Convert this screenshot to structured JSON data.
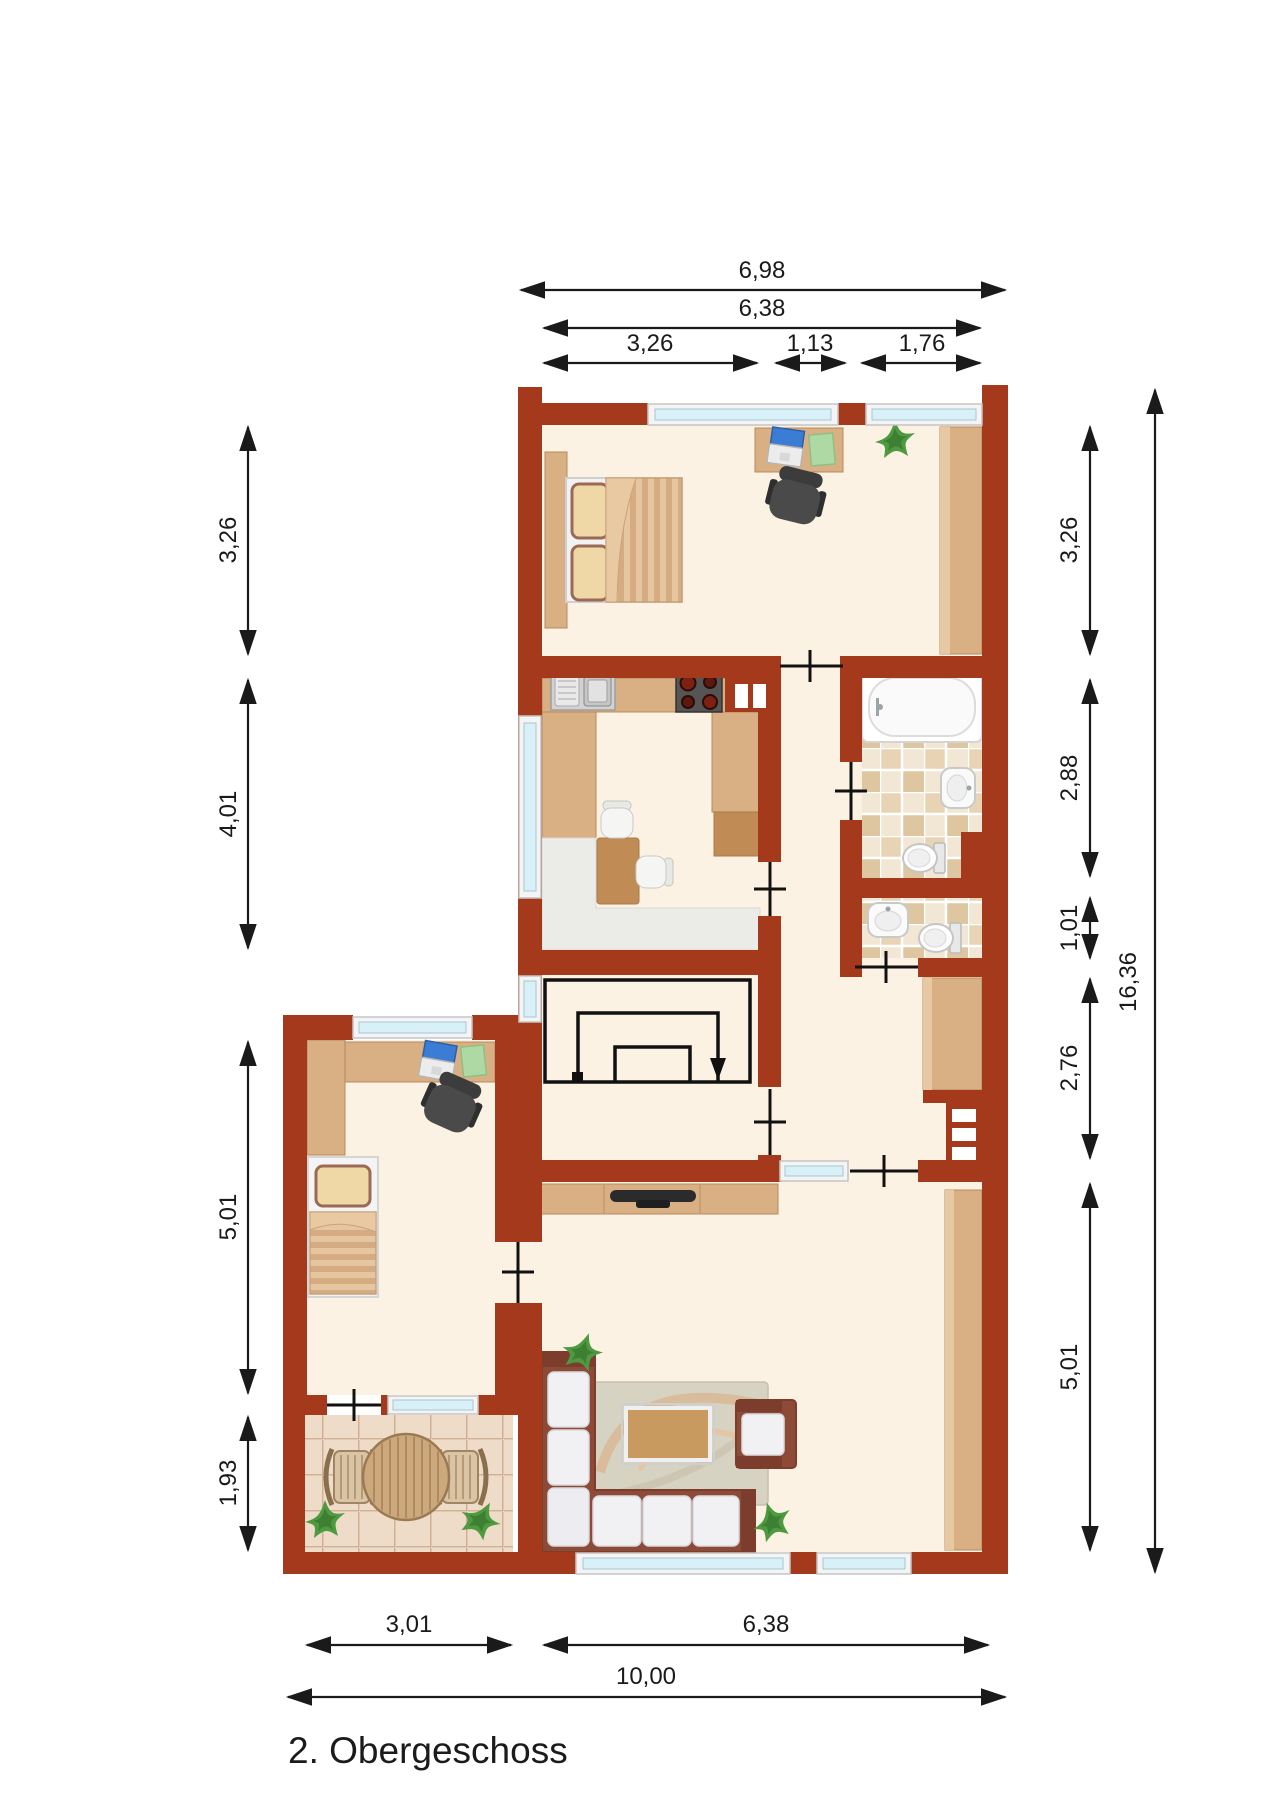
{
  "title": "2. Obergeschoss",
  "dimensions": {
    "top": [
      "6,98",
      "6,38",
      "3,26",
      "1,13",
      "1,76"
    ],
    "left": [
      "3,26",
      "4,01",
      "5,01",
      "1,93"
    ],
    "right": [
      "3,26",
      "2,88",
      "1,01",
      "2,76",
      "5,01"
    ],
    "right_total": "16,36",
    "bottom": [
      "3,01",
      "6,38",
      "10,00"
    ]
  },
  "colors": {
    "wall": "#A4391B",
    "floor": "#FBF2E3",
    "wood": "#D9B083",
    "wood_dark": "#C08B55",
    "glass": "#D8F0F8",
    "frame": "#F4F4F4",
    "line": "#1A1A1A",
    "grey_counter": "#EBEBE7",
    "sofa": "#8D4A37",
    "sofa_dark": "#7C3D2C",
    "cushion": "#F1F1F4",
    "plant": "#4D9A40",
    "tile_a": "#F1E3CC",
    "tile_b": "#E2CBA6",
    "balcony_tile": "#EFDCC8"
  },
  "legend": {
    "rooms": [
      "bedroom-main",
      "kitchen",
      "bathroom",
      "wc",
      "stairwell-hall",
      "corridor",
      "bedroom-second",
      "living-room",
      "balcony"
    ]
  }
}
